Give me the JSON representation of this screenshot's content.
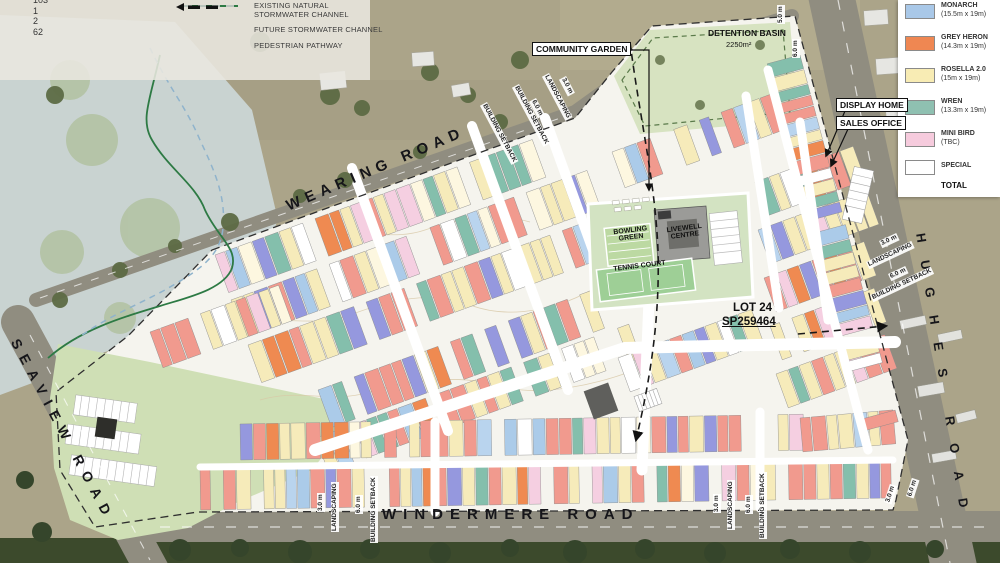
{
  "legend_counts": {
    "values": [
      "103",
      "1",
      "2",
      "62"
    ]
  },
  "line_legend": {
    "existing_channel": "EXISTING NATURAL STORMWATER CHANNEL",
    "future_channel": "FUTURE STORMWATER CHANNEL",
    "pedestrian": "PEDESTRIAN PATHWAY"
  },
  "lot_legend": {
    "items": [
      {
        "name": "MONARCH",
        "size": "(15.5m x 19m)",
        "color": "#a9c8e8"
      },
      {
        "name": "GREY HERON",
        "size": "(14.3m x 19m)",
        "color": "#ef8752"
      },
      {
        "name": "ROSELLA 2.0",
        "size": "(15m x 19m)",
        "color": "#f8ecb4"
      },
      {
        "name": "WREN",
        "size": "(13.3m x 19m)",
        "color": "#8fc0b1"
      },
      {
        "name": "MINI BIRD",
        "size": "(TBC)",
        "color": "#f6cbdd"
      },
      {
        "name": "SPECIAL",
        "size": "",
        "color": "#ffffff"
      }
    ],
    "total_label": "TOTAL"
  },
  "roads": {
    "wearing": "WEARING ROAD",
    "seaview": "SEAVIEW ROAD",
    "windermere": "WINDERMERE ROAD",
    "hughes": "HUGHES ROAD"
  },
  "labels": {
    "community_garden": "COMMUNITY GARDEN",
    "detention_basin": "DETENTION BASIN",
    "detention_basin_area": "2250m²",
    "display_home": "DISPLAY HOME",
    "sales_office": "SALES OFFICE",
    "lot": "LOT 24",
    "plan": "SP259464",
    "bowling_green": "BOWLING GREEN",
    "livewell_centre": "LIVEWELL CENTRE",
    "tennis_court": "TENNIS COURT"
  },
  "annotations": {
    "landscaping": "LANDSCAPING",
    "building_setback": "BUILDING SETBACK",
    "dim_3_0": "3.0 m",
    "dim_6_0": "6.0 m",
    "dim_5_0": "5.0 m"
  },
  "map": {
    "colors": {
      "field": "#aba489",
      "floodplain": "#c9d3d1",
      "flood_green": "#b2c2a2",
      "trees_dark": "#3c4a2c",
      "tree": "#5d6b44",
      "road": "#908d80",
      "estate": "#f5f4ee",
      "greenspace": "#cfdfb5",
      "det_basin": "#d7e3c1",
      "community": "#d3e3c2",
      "bowling": "#bcd9a2",
      "tennis": "#9ecf96",
      "building": "#9b9b98",
      "dark_building": "#2e2e2a",
      "boundary": "#2f2f2f",
      "channel_green": "#2d7a44",
      "channel_blue": "#8fb3cc",
      "path_black": "#1a1a1a",
      "legend_backdrop": "#e9e7df"
    },
    "lot_palette": [
      "#f6ebba",
      "#f19a8e",
      "#f6ebba",
      "#abcbe9",
      "#f19a8e",
      "#f6ebba",
      "#f5cfe1",
      "#ef8a51",
      "#f6ebba",
      "#84bfac",
      "#f19a8e",
      "#9598de",
      "#f6ebba",
      "#b9d4ee",
      "#f19a8e",
      "#fdf7e0",
      "#ef8a51",
      "#9598de",
      "#f19a8e",
      "#f6ebba",
      "#84bfac",
      "#f5cfe1",
      "#abcbe9",
      "#f6ebba",
      "#ffffff",
      "#f19a8e"
    ]
  }
}
